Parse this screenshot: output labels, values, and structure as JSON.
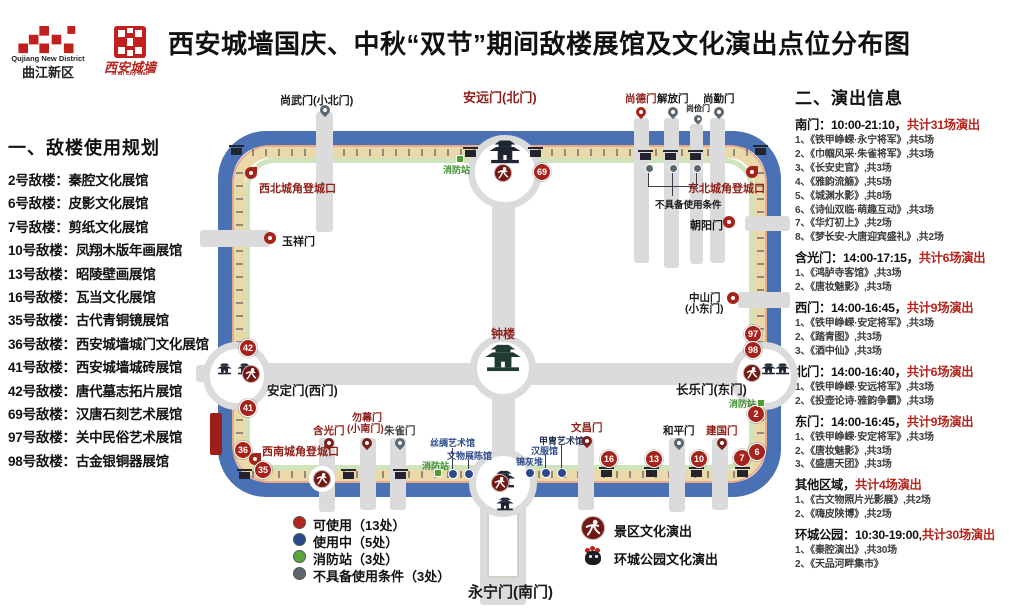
{
  "header": {
    "title": "西安城墙国庆、中秋“双节”期间敌楼展馆及文化演出点位分布图",
    "logo_qujiang_en": "Qujiang New District",
    "logo_qujiang_zh": "曲江新区",
    "logo_wall_zh": "西安城墙",
    "logo_wall_en": "Xi'an City Wall"
  },
  "left_panel": {
    "heading": "一、敌楼使用规划",
    "items": [
      "2号敌楼：秦腔文化展馆",
      "6号敌楼：皮影文化展馆",
      "7号敌楼：剪纸文化展馆",
      "10号敌楼：凤翔木版年画展馆",
      "13号敌楼：昭陵壁画展馆",
      "16号敌楼：瓦当文化展馆",
      "35号敌楼：古代青铜镜展馆",
      "36号敌楼：西安城墙城门文化展馆",
      "41号敌楼：西安城墙城砖展馆",
      "42号敌楼：唐代墓志拓片展馆",
      "69号敌楼：汉唐石刻艺术展馆",
      "97号敌楼：关中民俗艺术展馆",
      "98号敌楼：古金银铜器展馆"
    ]
  },
  "right_panel": {
    "heading": "二、演出信息",
    "sections": [
      {
        "label": "南门：10:00-21:10，",
        "count": "共计31场演出",
        "items": [
          "1、《铁甲峥嵘·永宁将军》,共5场",
          "2、《巾帼风采·朱雀将军》,共3场",
          "3、《长安史官》,共3场",
          "4、《雅韵流觞》,共5场",
          "5、《城渊水影》,共8场",
          "6、《诗仙双临·萌趣互动》,共3场",
          "7、《华灯初上》,共2场",
          "8、《梦长安-大唐迎宾盛礼》,共2场"
        ]
      },
      {
        "label": "含光门：14:00-17:15，",
        "count": "共计6场演出",
        "items": [
          "1、《鸿胪寺客馆》,共3场",
          "2、《唐妆魅影》,共3场"
        ]
      },
      {
        "label": "西门：14:00-16:45，",
        "count": "共计9场演出",
        "items": [
          "1、《铁甲峥嵘·安定将军》,共3场",
          "2、《踏青图》,共3场",
          "3、《酒中仙》,共3场"
        ]
      },
      {
        "label": "北门：14:00-16:40，",
        "count": "共计6场演出",
        "items": [
          "1、《铁甲峥嵘·安远将军》,共3场",
          "2、《投壶论诗·雅韵争霸》,共3场"
        ]
      },
      {
        "label": "东门：14:00-16:45，",
        "count": "共计9场演出",
        "items": [
          "1、《铁甲峥嵘·安定将军》,共3场",
          "2、《唐妆魅影》,共3场",
          "3、《盛唐天团》,共3场"
        ]
      },
      {
        "label": "其他区域，",
        "count": "共计4场演出",
        "items": [
          "1、《古文物照片光影展》,共2场",
          "2、《嗨皮陕博》,共2场"
        ]
      },
      {
        "label": "环城公园：10:30-19:00,",
        "count": "共计30场演出",
        "items": [
          "1、《秦腔演出》,共30场",
          "2、《天品河畔集市》"
        ]
      }
    ]
  },
  "map": {
    "gates": {
      "shangwu": "尚武门(小北门)",
      "anyuan": "安远门(北门)",
      "shangde": "尚德门",
      "jiefang": "解放门",
      "shangjian": "尚俭门",
      "shangqin": "尚勤门",
      "chaoyang": "朝阳门",
      "zhongshan_l1": "中山门",
      "zhongshan_l2": "(小东门)",
      "changle": "长乐门(东门)",
      "yuxiang": "玉祥门",
      "anding": "安定门(西门)",
      "hanguang": "含光门",
      "wumu_l1": "勿幕门",
      "wumu_l2": "(小南门)",
      "zhuque": "朱雀门",
      "wenchang": "文昌门",
      "heping": "和平门",
      "jianguo": "建国门",
      "yongning": "永宁门(南门)"
    },
    "pois": {
      "nw_entry": "西北城角登城口",
      "ne_entry": "东北城角登城口",
      "sw_entry": "西南城角登城口",
      "bell_tower": "钟楼",
      "unavailable_note": "不具备使用条件",
      "fire_station": "消防站",
      "silk_hall": "丝绸艺术馆",
      "relic_hall": "文物展陈馆",
      "jinhuidui": "锦灰堆",
      "hanfu_hall": "汉服馆",
      "armor_hall": "甲胄艺术馆"
    },
    "badges": {
      "b2": "2",
      "b6": "6",
      "b7": "7",
      "b10": "10",
      "b13": "13",
      "b16": "16",
      "b35": "35",
      "b36": "36",
      "b41": "41",
      "b42": "42",
      "b69": "69",
      "b97": "97",
      "b98": "98"
    }
  },
  "legend": {
    "usable": "可使用（13处）",
    "in_use": "使用中（5处）",
    "fire": "消防站（3处）",
    "unavailable": "不具备使用条件（3处）",
    "scenic_show": "景区文化演出",
    "park_show": "环城公园文化演出"
  },
  "colors": {
    "accent_red": "#a6231c",
    "moat_blue": "#4a71b4",
    "wall_beige": "#ead9ab",
    "fire_green": "#4f9e35",
    "in_use_blue": "#2b4a8b",
    "unavailable_gray": "#5b6770"
  }
}
